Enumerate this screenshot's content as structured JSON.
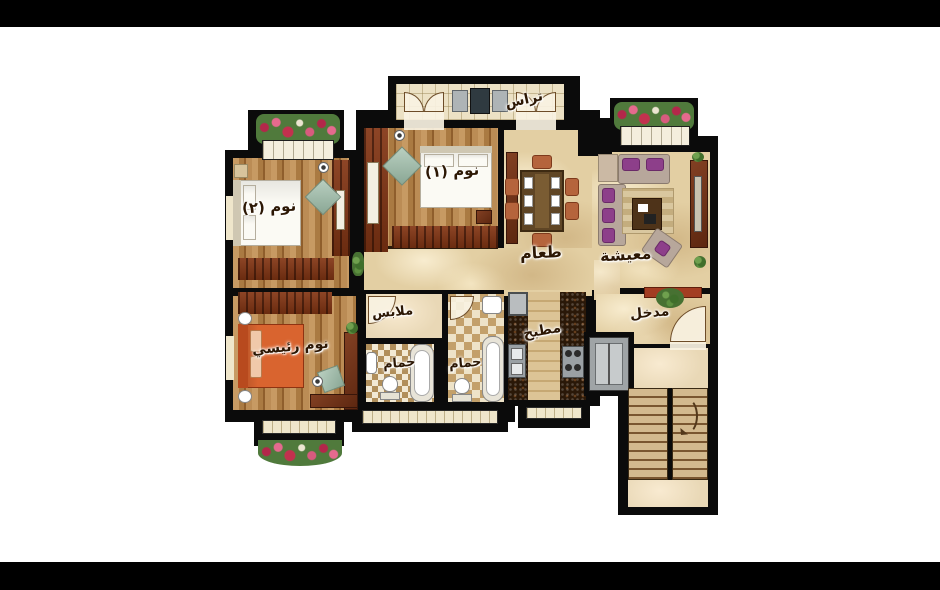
{
  "scene": {
    "type": "residential apartment floor plan (rendered, top view)",
    "language": "Arabic",
    "background": "#ffffff",
    "letterbox_color": "#000000"
  },
  "colors": {
    "wall": "#0b0b0b",
    "marble_floor": "#e3cfa3",
    "wood_floor": "#aa7a42",
    "dark_wood_furniture": "#6f2e12",
    "sofa_upholstery": "#b7a79b",
    "sofa_cushion": "#8d3f8a",
    "master_bed": "#d9642f",
    "flower_red": "#b3274a",
    "label_text": "#2c1704"
  },
  "rooms": {
    "terrace": {
      "label": "تراس"
    },
    "bedroom1": {
      "label": "نوم (١)"
    },
    "bedroom2": {
      "label": "نوم (٢)"
    },
    "dining": {
      "label": "طعام"
    },
    "living": {
      "label": "معيشة"
    },
    "master_bedroom": {
      "label": "نوم رئيسي"
    },
    "dressing": {
      "label": "ملابس"
    },
    "bathroom1": {
      "label": "حمام"
    },
    "bathroom2": {
      "label": "حمام"
    },
    "kitchen": {
      "label": "مطبخ"
    },
    "entrance": {
      "label": "مدخل"
    }
  }
}
